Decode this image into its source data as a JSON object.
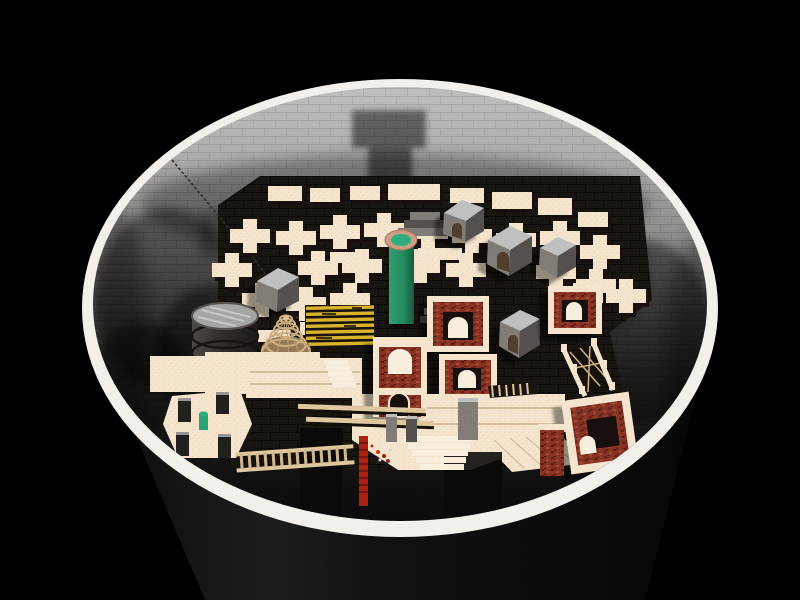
{
  "scene": {
    "type": "3d-render",
    "subject": "circular brick pit viewed from above containing a miniature maze city",
    "objects": [
      "pit-exterior-cylinder",
      "white-rim",
      "interior-brick-wall",
      "wall-shadows",
      "maze-walls",
      "green-column-with-ring",
      "wooden-barrel",
      "wicker-cone",
      "gold-scaffold",
      "stone-huts",
      "red-brick-arch-towers",
      "rail-bridge",
      "ladder-bridge",
      "staircases",
      "corner-post-platform",
      "hanging-chain",
      "horizontal-ladder",
      "red-ladder",
      "plank-rails",
      "grey-monoliths",
      "scatter-debris"
    ]
  },
  "palette": {
    "background": "#000000",
    "rim_white": "#f2efe9",
    "wall_top": "#b6b4b1",
    "wall_mid": "#7d7b78",
    "wall_dark": "#0b0a0a",
    "exterior_dark": "#131312",
    "cream": "#f4e2c8",
    "cream_shade": "#d9bf9e",
    "wall_side_dark": "#262019",
    "brick_red": "#7b2e20",
    "green": "#1f8057",
    "green_light": "#2aa572",
    "ring_tan": "#c69279",
    "gold": "#d7ab28",
    "barrel_dark": "#2e2b29",
    "barrel_top": "#9b9b99",
    "stone_grey_top": "#b9b9b9",
    "stone_grey_front": "#76716c",
    "stone_grey_side": "#4e4a46",
    "wicker": "#c2a379",
    "ladder_tan": "#dcc194",
    "ladder_red": "#a31f10"
  }
}
